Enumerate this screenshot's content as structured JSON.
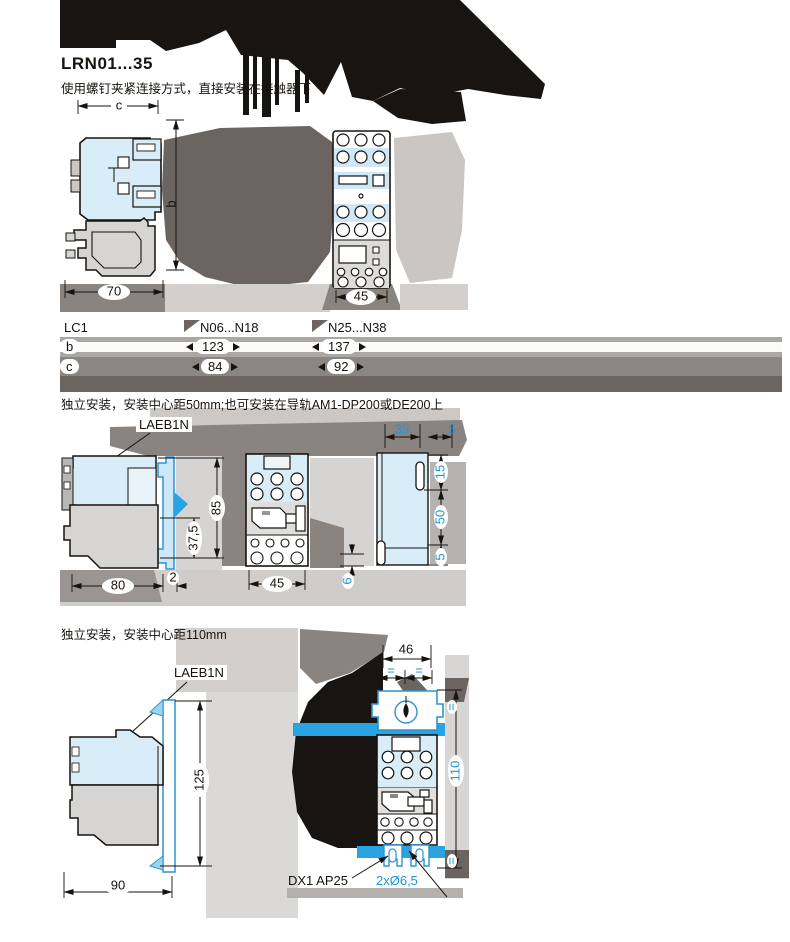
{
  "title": "LRN01...35",
  "subtitle": "使用螺钉夹紧连接方式，直接安装在接触器下",
  "sections": {
    "mid_text": "独立安装，安装中心距50mm;也可安装在导轨AM1-DP200或DE200上",
    "bottom_text": "独立安装，安装中心距110mm"
  },
  "colors": {
    "dim_accent": "#2196d6",
    "highlight_bar": "#29a3e2",
    "drawing_fill_blue": "#d9edf8",
    "blob_dark": "#181411",
    "blob_taupe": "#6b6460"
  },
  "fig1": {
    "dim_c": "c",
    "dim_b": "b",
    "dim_width_side": "70",
    "dim_width_front": "45"
  },
  "table": {
    "headers": [
      "LC1",
      "N06...N18",
      "N25...N38"
    ],
    "rows": [
      {
        "label": "b",
        "v1": "123",
        "v2": "137"
      },
      {
        "label": "c",
        "v1": "84",
        "v2": "92"
      }
    ]
  },
  "fig2": {
    "callout": "LAEB1N",
    "dim_80": "80",
    "dim_2": "2",
    "dim_37_5": "37,5",
    "dim_85": "85",
    "dim_45": "45",
    "dim_35": "35",
    "dim_5_top": "5",
    "dim_15": "15",
    "dim_50": "50",
    "dim_5_bot": "5",
    "dim_6": "6"
  },
  "fig3": {
    "callout": "LAEB1N",
    "plate_label": "DX1 AP25",
    "holes_label": "2xØ6,5",
    "dim_46": "46",
    "dim_90": "90",
    "dim_125": "125",
    "dim_110": "110",
    "dim_eq": "="
  }
}
